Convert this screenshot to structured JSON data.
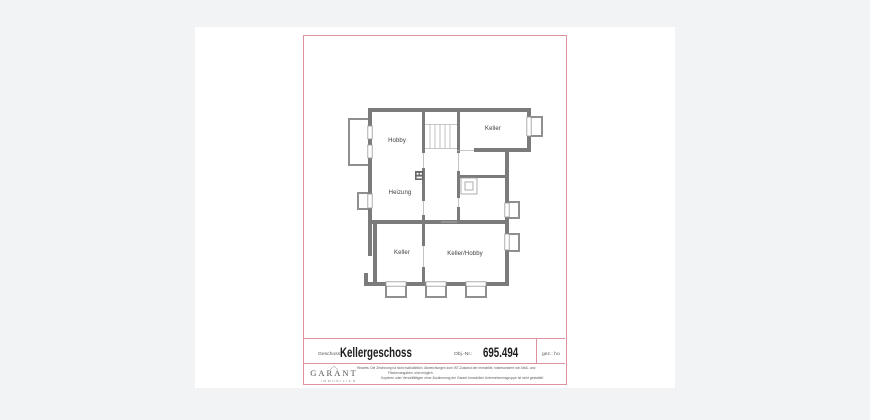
{
  "plan": {
    "rooms": [
      {
        "label": "Hobby"
      },
      {
        "label": "Keller"
      },
      {
        "label": "Heizung"
      },
      {
        "label": "Keller"
      },
      {
        "label": "Keller/Hobby"
      }
    ]
  },
  "footer": {
    "geschoss_label": "Geschoss:",
    "geschoss_value": "Kellergeschoss",
    "obj_label": "Obj.-Nr.:",
    "obj_value": "695.494",
    "gez_label": "gez.: ho",
    "logo_name": "GARANT",
    "logo_sub": "IMMOBILIEN",
    "disclaimer": [
      "Hinweis: Die Zeichnung ist nicht maßstäblich. Abweichungen zum IST-Zustand der Immobilie, insbesondere von Maß- und",
      "Flächenangaben, sind möglich.",
      "Kopieren oder Vervielfältigen ohne Zustimmung der Garant Immobilien Unternehmensgruppe ist nicht gestattet!"
    ]
  },
  "colors": {
    "frame_red": "#dd92a0",
    "wall_gray": "#7b7b7b",
    "lightwell_gray": "#8f8f8f",
    "thin_line_gray": "#b4b4b4",
    "background": "#f2f3f4",
    "paper": "#ffffff"
  }
}
